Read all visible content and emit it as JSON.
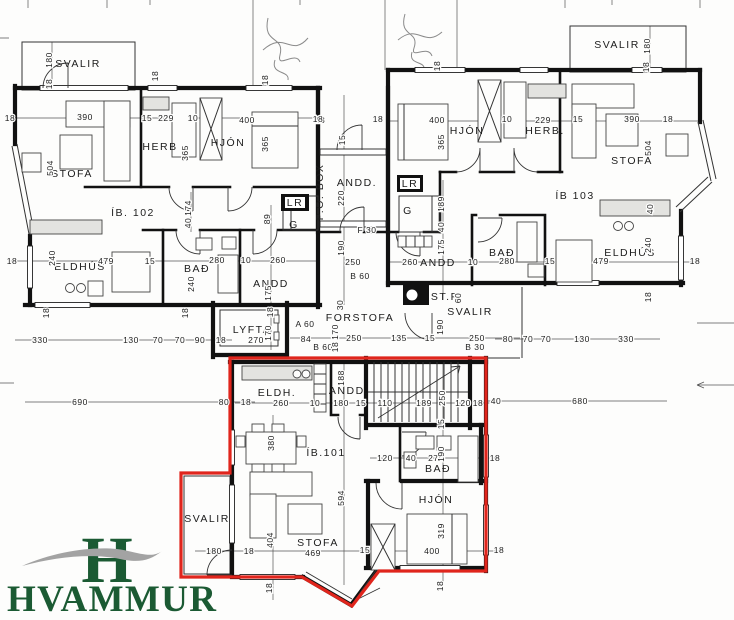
{
  "drawing": {
    "highlight_outline_color": "#e0251c",
    "wall_color": "#111111",
    "apartments": [
      {
        "id": "ÍB. 102"
      },
      {
        "id": "ÍB 103"
      },
      {
        "id": "ÍB.101",
        "highlighted": true
      }
    ]
  },
  "logo": {
    "monogram": "H",
    "name": "HVAMMUR",
    "green": "#1b5a33",
    "swoosh_gray": "#a3a3a3"
  },
  "room_labels": [
    {
      "t": "SVALIR",
      "x": 78,
      "y": 67
    },
    {
      "t": "STOFA",
      "x": 72,
      "y": 177
    },
    {
      "t": "HERB",
      "x": 160,
      "y": 150
    },
    {
      "t": "HJÓN",
      "x": 228,
      "y": 146
    },
    {
      "t": "ÍB. 102",
      "x": 133,
      "y": 216,
      "size": 12
    },
    {
      "t": "ELDHÚS",
      "x": 80,
      "y": 270
    },
    {
      "t": "BAÐ",
      "x": 197,
      "y": 272
    },
    {
      "t": "ANDD",
      "x": 271,
      "y": 287
    },
    {
      "t": "LYFTA",
      "x": 252,
      "y": 333
    },
    {
      "t": "FORSTOFA",
      "x": 360,
      "y": 321
    },
    {
      "t": "ANDD.",
      "x": 357,
      "y": 186
    },
    {
      "t": "P.O. BOX",
      "x": 323,
      "y": 192,
      "rot": -90,
      "size": 9
    },
    {
      "t": "ANDD",
      "x": 438,
      "y": 266
    },
    {
      "t": "ST.P",
      "x": 445,
      "y": 300,
      "size": 9
    },
    {
      "t": "SVALIR",
      "x": 470,
      "y": 315
    },
    {
      "t": "HJÓN",
      "x": 467,
      "y": 134
    },
    {
      "t": "HERB.",
      "x": 545,
      "y": 134
    },
    {
      "t": "SVALIR",
      "x": 617,
      "y": 48
    },
    {
      "t": "STOFA",
      "x": 632,
      "y": 164
    },
    {
      "t": "ÍB 103",
      "x": 575,
      "y": 199,
      "size": 12
    },
    {
      "t": "BAÐ",
      "x": 502,
      "y": 256
    },
    {
      "t": "ELDHÚS",
      "x": 630,
      "y": 256
    },
    {
      "t": "LR",
      "x": 295,
      "y": 206,
      "size": 8
    },
    {
      "t": "G",
      "x": 294,
      "y": 228,
      "size": 9.5
    },
    {
      "t": "LR",
      "x": 410,
      "y": 187,
      "size": 8
    },
    {
      "t": "G",
      "x": 408,
      "y": 214,
      "size": 9.5
    },
    {
      "t": "ELDH.",
      "x": 277,
      "y": 396,
      "size": 10
    },
    {
      "t": "ANDD.",
      "x": 349,
      "y": 394,
      "size": 10
    },
    {
      "t": "ÍB.101",
      "x": 326,
      "y": 456,
      "size": 12
    },
    {
      "t": "BAÐ",
      "x": 438,
      "y": 472,
      "size": 10
    },
    {
      "t": "HJÓN",
      "x": 436,
      "y": 503
    },
    {
      "t": "STOFA",
      "x": 318,
      "y": 546
    },
    {
      "t": "SVALIR",
      "x": 207,
      "y": 522
    }
  ],
  "dim_labels": [
    {
      "t": "180",
      "x": 52,
      "y": 60,
      "rot": -90
    },
    {
      "t": "18",
      "x": 52,
      "y": 84,
      "rot": -90
    },
    {
      "t": "18",
      "x": 10,
      "y": 121
    },
    {
      "t": "390",
      "x": 85,
      "y": 120
    },
    {
      "t": "15",
      "x": 147,
      "y": 121
    },
    {
      "t": "229",
      "x": 166,
      "y": 121
    },
    {
      "t": "10",
      "x": 193,
      "y": 121
    },
    {
      "t": "400",
      "x": 247,
      "y": 123
    },
    {
      "t": "18",
      "x": 320,
      "y": 123
    },
    {
      "t": "18",
      "x": 158,
      "y": 76,
      "rot": -90
    },
    {
      "t": "18",
      "x": 268,
      "y": 80,
      "rot": -90
    },
    {
      "t": "365",
      "x": 188,
      "y": 153,
      "rot": -90
    },
    {
      "t": "365",
      "x": 268,
      "y": 144,
      "rot": -90
    },
    {
      "t": "504",
      "x": 53,
      "y": 168,
      "rot": -90
    },
    {
      "t": "174",
      "x": 191,
      "y": 208,
      "rot": -90
    },
    {
      "t": "40",
      "x": 191,
      "y": 223,
      "rot": -90
    },
    {
      "t": "89",
      "x": 270,
      "y": 219,
      "rot": -90
    },
    {
      "t": "240",
      "x": 55,
      "y": 258,
      "rot": -90
    },
    {
      "t": "18",
      "x": 12,
      "y": 264
    },
    {
      "t": "479",
      "x": 106,
      "y": 264
    },
    {
      "t": "15",
      "x": 150,
      "y": 264
    },
    {
      "t": "280",
      "x": 217,
      "y": 263
    },
    {
      "t": "10",
      "x": 246,
      "y": 263
    },
    {
      "t": "260",
      "x": 278,
      "y": 263
    },
    {
      "t": "240",
      "x": 194,
      "y": 284,
      "rot": -90
    },
    {
      "t": "175",
      "x": 271,
      "y": 293,
      "rot": -90
    },
    {
      "t": "18",
      "x": 49,
      "y": 313,
      "rot": -90
    },
    {
      "t": "18",
      "x": 188,
      "y": 313,
      "rot": -90
    },
    {
      "t": "18",
      "x": 273,
      "y": 312,
      "rot": -90
    },
    {
      "t": "330",
      "x": 40,
      "y": 343
    },
    {
      "t": "130",
      "x": 131,
      "y": 343
    },
    {
      "t": "70",
      "x": 158,
      "y": 343
    },
    {
      "t": "70",
      "x": 180,
      "y": 343
    },
    {
      "t": "90",
      "x": 200,
      "y": 343
    },
    {
      "t": "18",
      "x": 221,
      "y": 343
    },
    {
      "t": "270",
      "x": 256,
      "y": 343
    },
    {
      "t": "170",
      "x": 271,
      "y": 333,
      "rot": -90
    },
    {
      "t": "A 60",
      "x": 305,
      "y": 327
    },
    {
      "t": "84",
      "x": 306,
      "y": 342
    },
    {
      "t": "B 60",
      "x": 323,
      "y": 350
    },
    {
      "t": "30",
      "x": 343,
      "y": 305,
      "rot": -90
    },
    {
      "t": "170",
      "x": 338,
      "y": 332,
      "rot": -90
    },
    {
      "t": "18",
      "x": 338,
      "y": 347,
      "rot": -90
    },
    {
      "t": "250",
      "x": 354,
      "y": 341
    },
    {
      "t": "135",
      "x": 399,
      "y": 341
    },
    {
      "t": "15",
      "x": 430,
      "y": 341
    },
    {
      "t": "190",
      "x": 443,
      "y": 327,
      "rot": -90
    },
    {
      "t": "250",
      "x": 477,
      "y": 341
    },
    {
      "t": "B 30",
      "x": 475,
      "y": 350
    },
    {
      "t": "80",
      "x": 508,
      "y": 342
    },
    {
      "t": "70",
      "x": 528,
      "y": 342
    },
    {
      "t": "70",
      "x": 546,
      "y": 342
    },
    {
      "t": "130",
      "x": 582,
      "y": 342
    },
    {
      "t": "330",
      "x": 626,
      "y": 342
    },
    {
      "t": "18",
      "x": 318,
      "y": 122
    },
    {
      "t": "18",
      "x": 378,
      "y": 122
    },
    {
      "t": "15",
      "x": 345,
      "y": 140,
      "rot": -90
    },
    {
      "t": "220",
      "x": 344,
      "y": 198,
      "rot": -90
    },
    {
      "t": "F 30",
      "x": 367,
      "y": 233
    },
    {
      "t": "190",
      "x": 344,
      "y": 248,
      "rot": -90
    },
    {
      "t": "250",
      "x": 353,
      "y": 265
    },
    {
      "t": "B 60",
      "x": 360,
      "y": 279
    },
    {
      "t": "60",
      "x": 461,
      "y": 298,
      "rot": -90
    },
    {
      "t": "175",
      "x": 444,
      "y": 247,
      "rot": -90
    },
    {
      "t": "40",
      "x": 444,
      "y": 227,
      "rot": -90
    },
    {
      "t": "189",
      "x": 444,
      "y": 204,
      "rot": -90
    },
    {
      "t": "260",
      "x": 410,
      "y": 265
    },
    {
      "t": "10",
      "x": 473,
      "y": 265
    },
    {
      "t": "400",
      "x": 437,
      "y": 123
    },
    {
      "t": "10",
      "x": 507,
      "y": 122
    },
    {
      "t": "229",
      "x": 543,
      "y": 123
    },
    {
      "t": "15",
      "x": 578,
      "y": 122
    },
    {
      "t": "390",
      "x": 632,
      "y": 122
    },
    {
      "t": "18",
      "x": 668,
      "y": 122
    },
    {
      "t": "365",
      "x": 444,
      "y": 142,
      "rot": -90
    },
    {
      "t": "18",
      "x": 440,
      "y": 66,
      "rot": -90
    },
    {
      "t": "180",
      "x": 650,
      "y": 46,
      "rot": -90
    },
    {
      "t": "18",
      "x": 649,
      "y": 67,
      "rot": -90
    },
    {
      "t": "504",
      "x": 651,
      "y": 148,
      "rot": -90
    },
    {
      "t": "40",
      "x": 653,
      "y": 209,
      "rot": -90
    },
    {
      "t": "240",
      "x": 651,
      "y": 245,
      "rot": -90
    },
    {
      "t": "18",
      "x": 695,
      "y": 264
    },
    {
      "t": "18",
      "x": 651,
      "y": 297,
      "rot": -90
    },
    {
      "t": "479",
      "x": 601,
      "y": 264
    },
    {
      "t": "15",
      "x": 550,
      "y": 264
    },
    {
      "t": "280",
      "x": 507,
      "y": 264
    },
    {
      "t": "690",
      "x": 80,
      "y": 405
    },
    {
      "t": "80",
      "x": 224,
      "y": 405
    },
    {
      "t": "18",
      "x": 246,
      "y": 405
    },
    {
      "t": "260",
      "x": 281,
      "y": 406
    },
    {
      "t": "10",
      "x": 315,
      "y": 406
    },
    {
      "t": "180",
      "x": 341,
      "y": 406
    },
    {
      "t": "15",
      "x": 361,
      "y": 406
    },
    {
      "t": "110",
      "x": 385,
      "y": 406
    },
    {
      "t": "189",
      "x": 424,
      "y": 406
    },
    {
      "t": "120",
      "x": 463,
      "y": 406
    },
    {
      "t": "18",
      "x": 478,
      "y": 406
    },
    {
      "t": "40",
      "x": 496,
      "y": 404
    },
    {
      "t": "680",
      "x": 580,
      "y": 404
    },
    {
      "t": "188",
      "x": 344,
      "y": 378,
      "rot": -90
    },
    {
      "t": "250",
      "x": 445,
      "y": 398,
      "rot": -90
    },
    {
      "t": "15",
      "x": 444,
      "y": 424,
      "rot": -90
    },
    {
      "t": "380",
      "x": 274,
      "y": 443,
      "rot": -90
    },
    {
      "t": "120",
      "x": 385,
      "y": 461
    },
    {
      "t": "40",
      "x": 411,
      "y": 461
    },
    {
      "t": "270",
      "x": 436,
      "y": 461
    },
    {
      "t": "190",
      "x": 444,
      "y": 454,
      "rot": -90
    },
    {
      "t": "18",
      "x": 495,
      "y": 461
    },
    {
      "t": "180",
      "x": 214,
      "y": 554
    },
    {
      "t": "18",
      "x": 249,
      "y": 554
    },
    {
      "t": "404",
      "x": 273,
      "y": 540,
      "rot": -90
    },
    {
      "t": "469",
      "x": 313,
      "y": 556
    },
    {
      "t": "594",
      "x": 344,
      "y": 498,
      "rot": -90
    },
    {
      "t": "15",
      "x": 365,
      "y": 553
    },
    {
      "t": "319",
      "x": 444,
      "y": 531,
      "rot": -90
    },
    {
      "t": "400",
      "x": 432,
      "y": 554
    },
    {
      "t": "18",
      "x": 499,
      "y": 553
    },
    {
      "t": "18",
      "x": 272,
      "y": 588,
      "rot": -90
    },
    {
      "t": "18",
      "x": 443,
      "y": 586,
      "rot": -90
    }
  ]
}
